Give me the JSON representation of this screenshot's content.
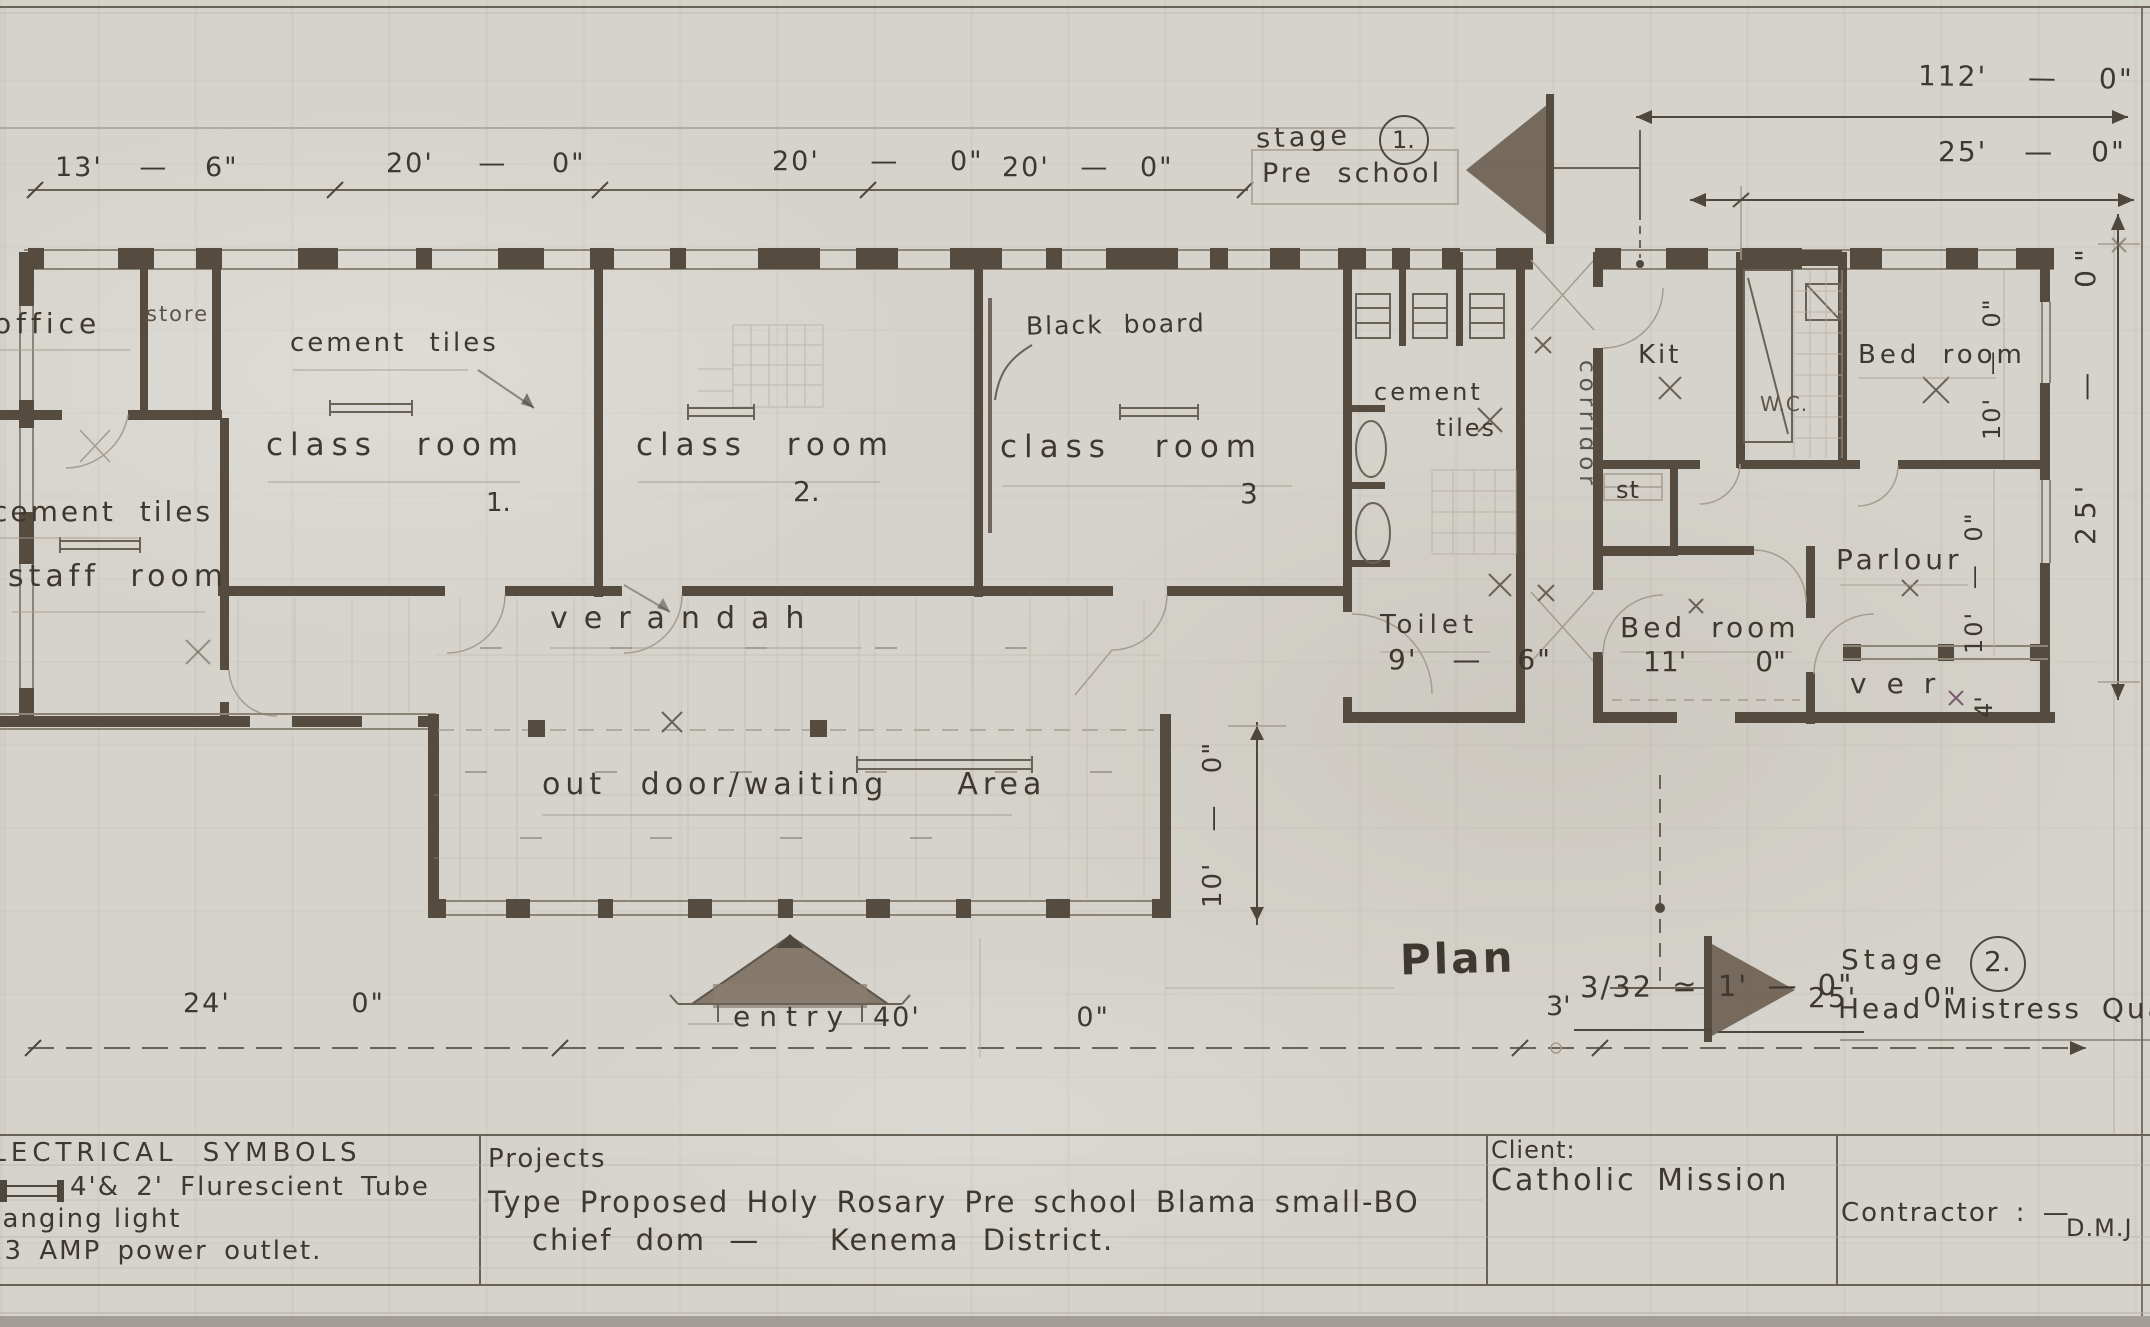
{
  "top": {
    "dims": [
      "13' — 6\"",
      "20' — 0\"",
      "20' — 0\"",
      "20' — 0\""
    ],
    "dim112": "112' — 0\"",
    "dim25": "25' — 0\"",
    "stage1": {
      "word": "stage",
      "num": "1.",
      "name": "Pre school"
    }
  },
  "rooms": {
    "office": "office",
    "store": "store",
    "class1": {
      "tiles": "cement tiles",
      "name": "class room",
      "num": "1."
    },
    "class2": {
      "name": "class room",
      "num": "2.",
      "blackboard": "Black board"
    },
    "class3": {
      "name": "class room",
      "num": "3"
    },
    "staff": {
      "tiles": "cement tiles",
      "name": "staff room"
    },
    "toilet": {
      "tiles1": "cement",
      "tiles2": "tiles",
      "name": "Toilet",
      "dim": "9' — 6\""
    },
    "corridor": "corridor",
    "verandah": "verandah",
    "outdoor": "out door/waiting  Area",
    "entry": "entry"
  },
  "hm": {
    "kit": "Kit",
    "wc": "W.C.",
    "bed_top": "Bed room",
    "st": "st",
    "bed_bottom": "Bed room",
    "bed_bottom_dim": "11' 0\"",
    "parlour": "Parlour",
    "ver": "ver",
    "dim_bed": "10' — 0\"",
    "dim_parlour": "10' — 0\"",
    "dim_ver": "4'",
    "dim_right": "25' — 0\"",
    "dim_outdoor": "10' — 0\""
  },
  "stage2": {
    "word": "Stage",
    "num": "2.",
    "name": "Head Mistress Quarters"
  },
  "plan": {
    "title": "Plan",
    "scale": "3/32 ≃ 1' — 0\""
  },
  "bottom_dims": [
    "24' 0\"",
    "40' 0\"",
    "3'",
    "25' 0\""
  ],
  "titleblock": {
    "electrical": {
      "title": "ELECTRICAL SYMBOLS",
      "tube": "4'& 2' Flurescient Tube",
      "light": "hanging light",
      "outlet": "13 AMP power outlet."
    },
    "projects": {
      "label": "Projects",
      "line1": "Type Proposed Holy Rosary Pre school Blama small-BO",
      "line2": "chief dom —   Kenema District."
    },
    "client": {
      "label": "Client:",
      "name": "Catholic Mission"
    },
    "contractor": {
      "label": "Contractor : —",
      "name": "D.M.J"
    }
  }
}
